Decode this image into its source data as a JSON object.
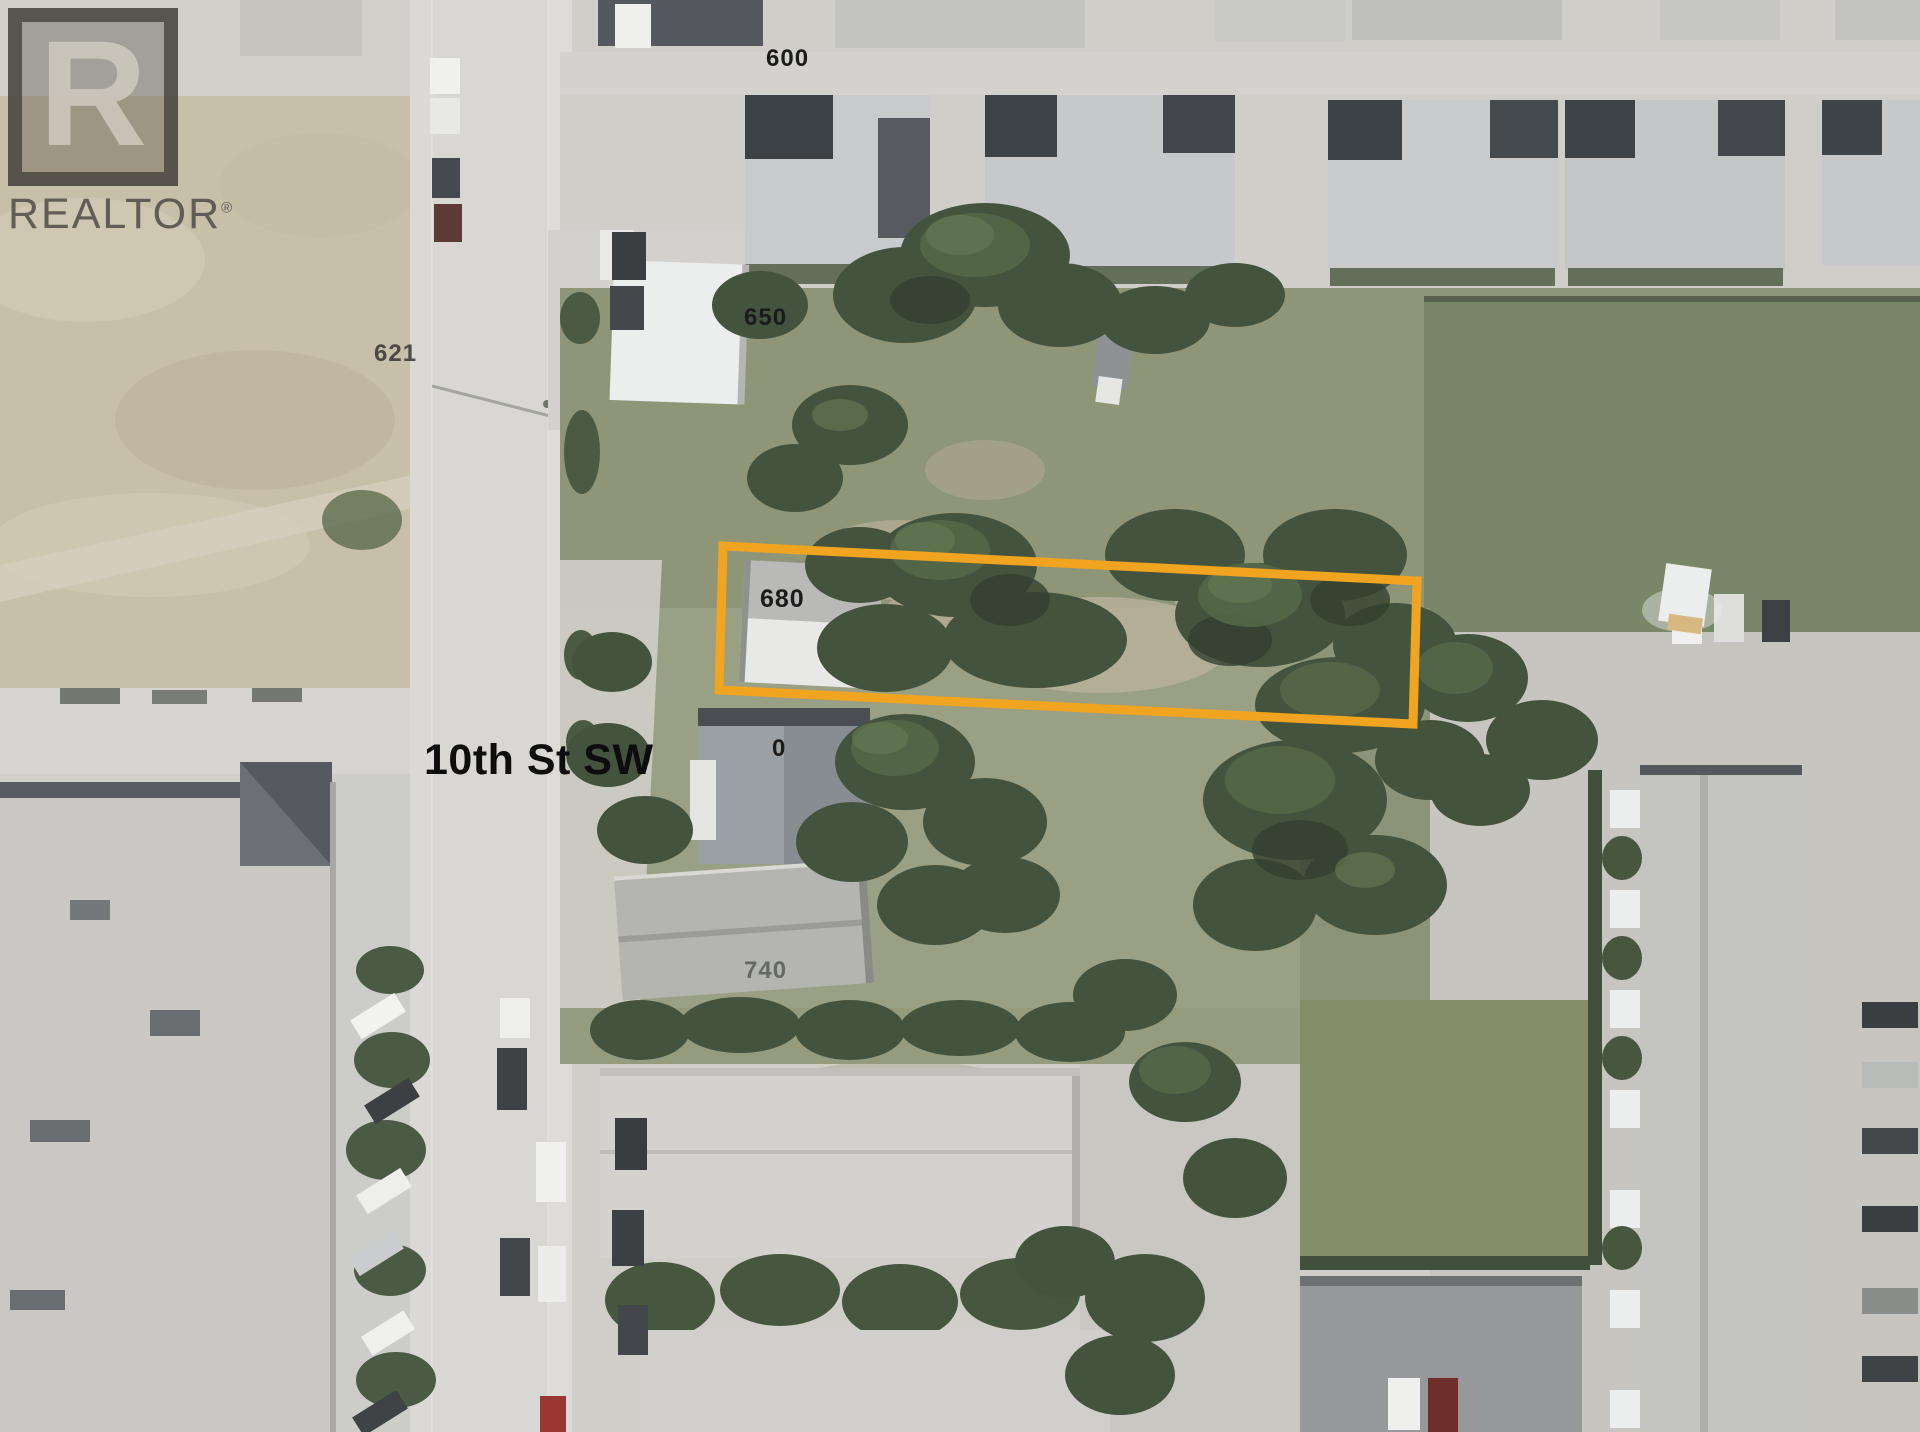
{
  "page": {
    "type": "aerial-listing-photo"
  },
  "watermark": {
    "logo_letter": "R",
    "brand_text": "REALTOR",
    "registered_symbol": "®"
  },
  "labels": {
    "street": "10th St SW",
    "lot_600": "600",
    "lot_621": "621",
    "lot_650": "650",
    "lot_680": "680",
    "lot_700_partial": "0",
    "lot_740": "740"
  },
  "colors": {
    "parcel_highlight": "#F1A41F",
    "road_asphalt": "#D8D7D3",
    "dirt_lot": "#C8BFA8",
    "lawn_green": "#778768",
    "backyard_green": "#8F9678",
    "tree_canopy": "#44533E",
    "roof_light": "#C9CACC",
    "roof_dark": "#3C4145",
    "roof_white": "#ECEDEB"
  }
}
